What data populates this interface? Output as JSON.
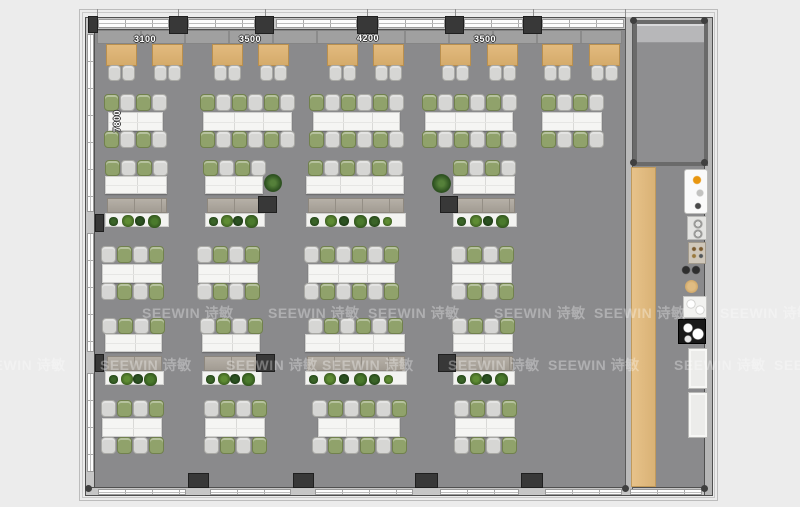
{
  "plan_name": "office-floor-plan",
  "dimensions": {
    "top": [
      {
        "text": "3100",
        "cx": 145,
        "y": 34
      },
      {
        "text": "3500",
        "cx": 250,
        "y": 34
      },
      {
        "text": "4200",
        "cx": 368,
        "y": 33
      },
      {
        "text": "3500",
        "cx": 485,
        "y": 34
      }
    ],
    "left": {
      "text": "7800",
      "x": 110,
      "y": 103
    }
  },
  "watermark": {
    "text": "SEEWIN 诗敏",
    "rows": [
      {
        "y": 303,
        "xs": [
          142,
          268,
          368,
          494,
          594,
          720
        ]
      },
      {
        "y": 355,
        "xs": [
          -26,
          100,
          226,
          322,
          448,
          548,
          674,
          774
        ]
      }
    ]
  },
  "colors": {
    "background": "#ececec",
    "floor": "#8a8a8c",
    "wall": "#c6c6c6",
    "column": "#383838",
    "wood_table": "#dcb478",
    "wood_strip": "#ddb679",
    "chair_gray": "#d6d6d4",
    "chair_green": "#90a26b",
    "desk_white": "#f5f5f3",
    "cabinet": "#aaa49b",
    "plant_green": "#3a6428",
    "accent_amber": "#e8960f"
  },
  "structure": {
    "ticks": [
      97,
      178,
      265,
      367,
      455,
      533,
      625
    ],
    "windows": {
      "top": [
        [
          98,
          169
        ],
        [
          188,
          255
        ],
        [
          276,
          357
        ],
        [
          378,
          445
        ],
        [
          464,
          523
        ],
        [
          542,
          624
        ]
      ],
      "bottom": [
        [
          98,
          186
        ],
        [
          210,
          291
        ],
        [
          315,
          413
        ],
        [
          440,
          519
        ],
        [
          545,
          622
        ],
        [
          630,
          702
        ]
      ],
      "left": [
        [
          34,
          212
        ],
        [
          233,
          352
        ],
        [
          373,
          472
        ]
      ]
    },
    "columns": [
      [
        88,
        16,
        10,
        17
      ],
      [
        169,
        16,
        19,
        18
      ],
      [
        255,
        16,
        19,
        18
      ],
      [
        357,
        16,
        21,
        18
      ],
      [
        445,
        16,
        19,
        18
      ],
      [
        523,
        16,
        19,
        18
      ],
      [
        95,
        214,
        9,
        18
      ],
      [
        95,
        354,
        9,
        18
      ],
      [
        188,
        473,
        21,
        15
      ],
      [
        293,
        473,
        21,
        15
      ],
      [
        415,
        473,
        23,
        15
      ],
      [
        521,
        473,
        22,
        15
      ],
      [
        258,
        196,
        19,
        17
      ],
      [
        440,
        196,
        18,
        17
      ],
      [
        256,
        354,
        19,
        18
      ],
      [
        438,
        354,
        18,
        18
      ]
    ],
    "corner_dots": [
      [
        630,
        17
      ],
      [
        701,
        17
      ],
      [
        630,
        159
      ],
      [
        701,
        159
      ],
      [
        701,
        485
      ],
      [
        85,
        485
      ],
      [
        622,
        485
      ]
    ],
    "bench": {
      "x": 97,
      "y": 30,
      "w": 525,
      "h": 14
    },
    "room": {
      "x": 633,
      "y": 20,
      "w": 75,
      "h": 146
    },
    "wood_strip": {
      "x": 631,
      "y": 167,
      "w": 25,
      "h": 320
    }
  },
  "furniture": {
    "booths": {
      "y": 44,
      "w": 31,
      "h": 22,
      "xs": [
        106,
        152,
        212,
        258,
        327,
        373,
        440,
        487,
        542,
        589
      ]
    },
    "cluster_rows": [
      {
        "y": 94,
        "items": [
          {
            "x": 108,
            "w": 55,
            "seats": 4,
            "start": "green"
          },
          {
            "x": 203,
            "w": 89,
            "seats": 6,
            "start": "green"
          },
          {
            "x": 313,
            "w": 87,
            "seats": 6,
            "start": "green"
          },
          {
            "x": 425,
            "w": 88,
            "seats": 6,
            "start": "green"
          },
          {
            "x": 542,
            "w": 60,
            "seats": 4,
            "start": "green"
          }
        ]
      },
      {
        "y": 246,
        "items": [
          {
            "x": 102,
            "w": 60,
            "seats": 4,
            "start": "gray"
          },
          {
            "x": 198,
            "w": 60,
            "seats": 4,
            "start": "gray"
          },
          {
            "x": 308,
            "w": 87,
            "seats": 6,
            "start": "gray"
          },
          {
            "x": 452,
            "w": 60,
            "seats": 4,
            "start": "gray"
          }
        ]
      },
      {
        "y": 400,
        "items": [
          {
            "x": 102,
            "w": 60,
            "seats": 4,
            "start": "gray"
          },
          {
            "x": 205,
            "w": 60,
            "seats": 4,
            "start": "gray"
          },
          {
            "x": 318,
            "w": 82,
            "seats": 6,
            "start": "gray"
          },
          {
            "x": 455,
            "w": 60,
            "seats": 4,
            "start": "gray"
          }
        ]
      }
    ],
    "desk_storage_rows": [
      {
        "y": 160,
        "items": [
          {
            "x": 105,
            "w": 62,
            "seats": 4,
            "start": "green"
          },
          {
            "x": 205,
            "w": 58,
            "seats": 4,
            "start": "green"
          },
          {
            "x": 306,
            "w": 98,
            "seats": 6,
            "start": "green"
          },
          {
            "x": 453,
            "w": 62,
            "seats": 4,
            "start": "green"
          }
        ]
      },
      {
        "y": 318,
        "items": [
          {
            "x": 105,
            "w": 57,
            "seats": 4,
            "start": "gray"
          },
          {
            "x": 202,
            "w": 58,
            "seats": 4,
            "start": "gray"
          },
          {
            "x": 305,
            "w": 100,
            "seats": 6,
            "start": "gray"
          },
          {
            "x": 453,
            "w": 60,
            "seats": 4,
            "start": "gray"
          }
        ]
      }
    ],
    "potted_plants": [
      {
        "x": 264,
        "y": 174,
        "s": 18
      },
      {
        "x": 432,
        "y": 174,
        "s": 19
      }
    ],
    "kitchen": [
      {
        "type": "counter",
        "x": 684,
        "y": 169,
        "w": 24,
        "h": 45
      },
      {
        "type": "sink",
        "x": 687,
        "y": 216,
        "w": 20,
        "h": 24
      },
      {
        "type": "appliance",
        "x": 688,
        "y": 242,
        "w": 18,
        "h": 22
      },
      {
        "type": "vents",
        "x": 681,
        "y": 265,
        "w": 20,
        "h": 10
      },
      {
        "type": "round-stool",
        "x": 685,
        "y": 280,
        "w": 13,
        "h": 13
      },
      {
        "type": "dish",
        "x": 683,
        "y": 296,
        "w": 24,
        "h": 22
      },
      {
        "type": "cooktop",
        "x": 678,
        "y": 319,
        "w": 28,
        "h": 25
      },
      {
        "type": "cabinet",
        "x": 688,
        "y": 348,
        "w": 20,
        "h": 41
      },
      {
        "type": "cabinet",
        "x": 688,
        "y": 392,
        "w": 20,
        "h": 46
      }
    ]
  }
}
